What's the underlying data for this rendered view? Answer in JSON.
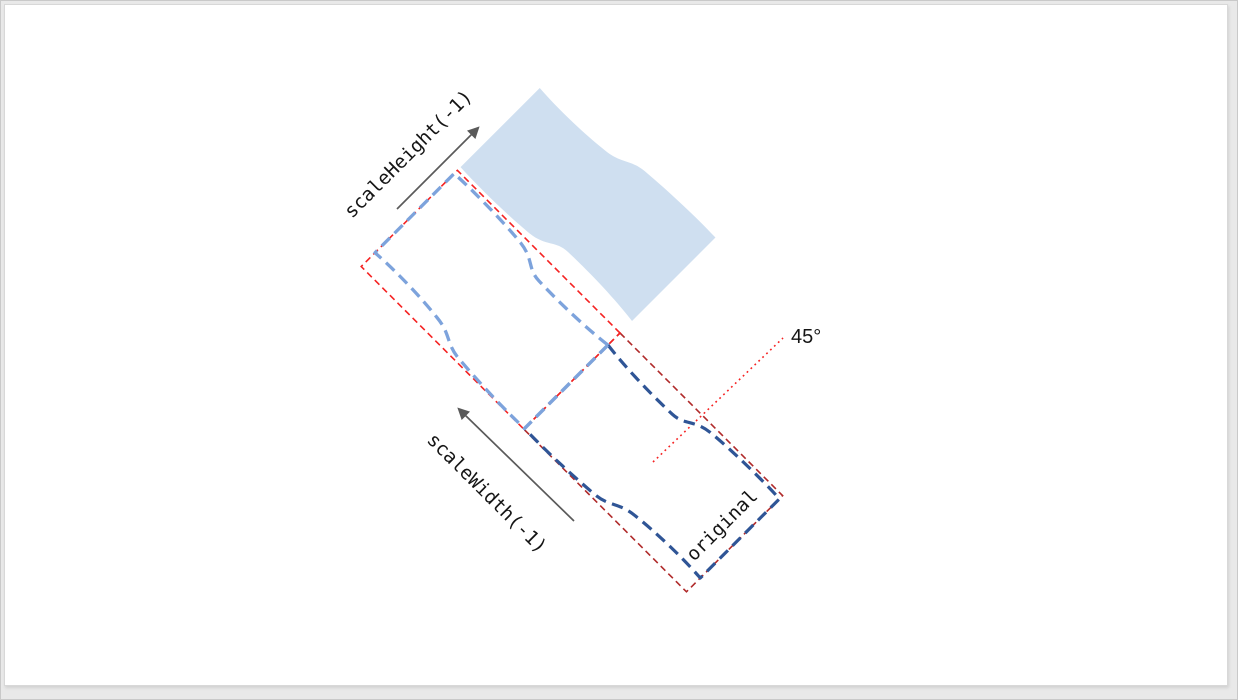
{
  "page": {
    "background": "#e9e9e9",
    "slide_background": "#ffffff",
    "slide_border": "#d8d8d8"
  },
  "labels": {
    "scale_height": "scaleHeight(-1)",
    "scale_width": "scaleWidth(-1)",
    "original": "original",
    "angle": "45°"
  },
  "colors": {
    "shape_fill": "#cfdff0",
    "flip_width_outline": "#7da3dc",
    "original_outline": "#2f5596",
    "flip_width_bbox": "#f52222",
    "original_bbox": "#b02a2a",
    "angle_line": "#f52222",
    "arrow": "#5a5a5a",
    "label_text": "#151515"
  },
  "shapes": {
    "wave_path": "M 0,17 C 28,20.5 62,21.5 94,20.5 C 111,20 113,9 134,6.5 C 159,4 200,3 230,4.5 L 230,116.5 C 202,114.5 166,115.5 140,118.5 C 119,120.5 116,130 97,132 C 66,134.5 30,136 0,135 Z",
    "bbox_width": 230,
    "bbox_height": 136,
    "rotation_deg": 45
  }
}
